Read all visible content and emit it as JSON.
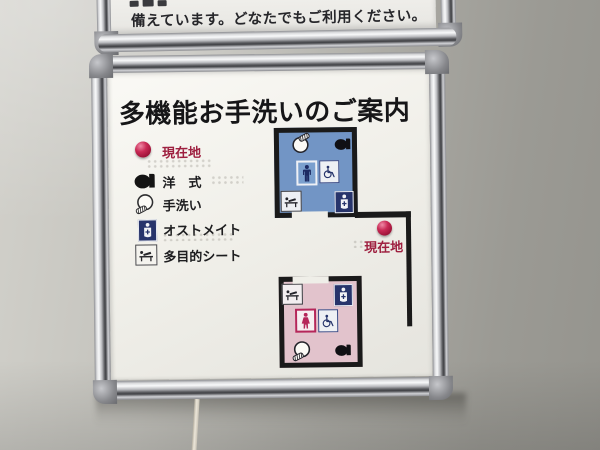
{
  "scene": {
    "description": "Photograph of a multi-function restroom guide sign in an aluminum frame mounted on a gray wall",
    "wall_color": "#b2b1ab",
    "frame_color": "#c9cacc",
    "board_color": "#f1f0ea"
  },
  "upper_sign": {
    "text": "備えています。どなたでもご利用ください。"
  },
  "sign": {
    "title": "多機能お手洗いのご案内",
    "accent_red": "#9e2040",
    "legend": {
      "items": [
        {
          "label": "現在地",
          "icon": "current-location-dot-icon",
          "text_color": "#9e2040"
        },
        {
          "label": "洋　式",
          "icon": "western-toilet-icon",
          "text_color": "#1d1d1f"
        },
        {
          "label": "手洗い",
          "icon": "hand-wash-sink-icon",
          "text_color": "#1d1d1f"
        },
        {
          "label": "オストメイト",
          "icon": "ostomate-icon",
          "text_color": "#1d1d1f"
        },
        {
          "label": "多目的シート",
          "icon": "multipurpose-sheet-icon",
          "text_color": "#1d1d1f"
        }
      ]
    },
    "map": {
      "current_location_label": "現在地",
      "walls_color": "#1a1a1a",
      "marker_color": "#b52247",
      "rooms": [
        {
          "name": "upper room (blue)",
          "fill": "#7295c5",
          "icons": [
            "hand-wash-sink",
            "western-toilet",
            "man",
            "wheelchair",
            "multipurpose-sheet",
            "ostomate"
          ]
        },
        {
          "name": "lower room (pink)",
          "fill": "#e2c3cc",
          "icons": [
            "multipurpose-sheet",
            "ostomate",
            "woman",
            "wheelchair",
            "hand-wash-sink",
            "western-toilet"
          ]
        }
      ]
    }
  }
}
